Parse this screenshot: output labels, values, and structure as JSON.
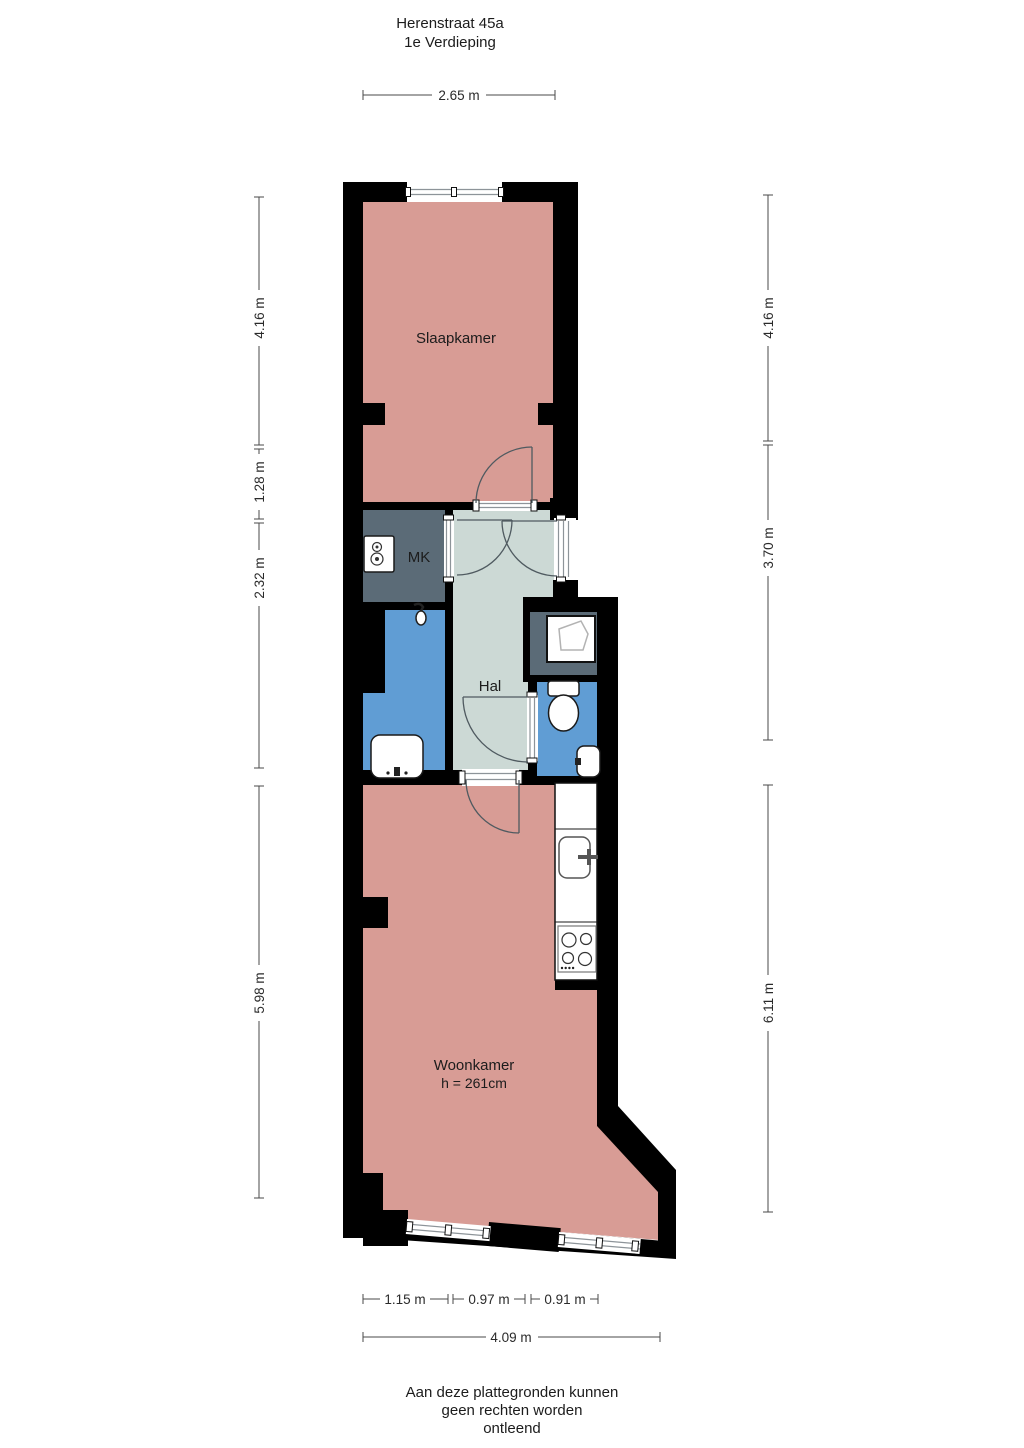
{
  "title": {
    "line1": "Herenstraat 45a",
    "line2": "1e Verdieping"
  },
  "rooms": {
    "slaapkamer": {
      "label": "Slaapkamer"
    },
    "mk": {
      "label": "MK"
    },
    "hal": {
      "label": "Hal"
    },
    "woonkamer": {
      "label": "Woonkamer",
      "ceiling_height": "h = 261cm"
    }
  },
  "dimensions": {
    "top": {
      "label": "2.65 m"
    },
    "left": [
      {
        "label": "4.16 m"
      },
      {
        "label": "1.28 m"
      },
      {
        "label": "2.32 m"
      },
      {
        "label": "5.98 m"
      }
    ],
    "right": [
      {
        "label": "4.16 m"
      },
      {
        "label": "3.70 m"
      },
      {
        "label": "6.11 m"
      }
    ],
    "bottom": [
      {
        "label": "1.15 m"
      },
      {
        "label": "0.97 m"
      },
      {
        "label": "0.91 m"
      }
    ],
    "bottom_total": {
      "label": "4.09 m"
    }
  },
  "footer": {
    "line1": "Aan deze plattegronden kunnen",
    "line2": "geen rechten worden",
    "line3": "ontleend"
  },
  "colors": {
    "wall": "#000000",
    "room_pink": "#d89c95",
    "hall_green": "#ccd9d5",
    "wet_blue": "#609dd4",
    "closet_gray": "#5b6b77"
  },
  "fixtures": [
    "boiler-icon",
    "shower-head-icon",
    "washbasin-icon",
    "shower-tray-icon",
    "toilet-icon",
    "hand-basin-icon",
    "kitchen-sink-icon",
    "cooktop-icon",
    "window-glyph",
    "door-arc"
  ]
}
